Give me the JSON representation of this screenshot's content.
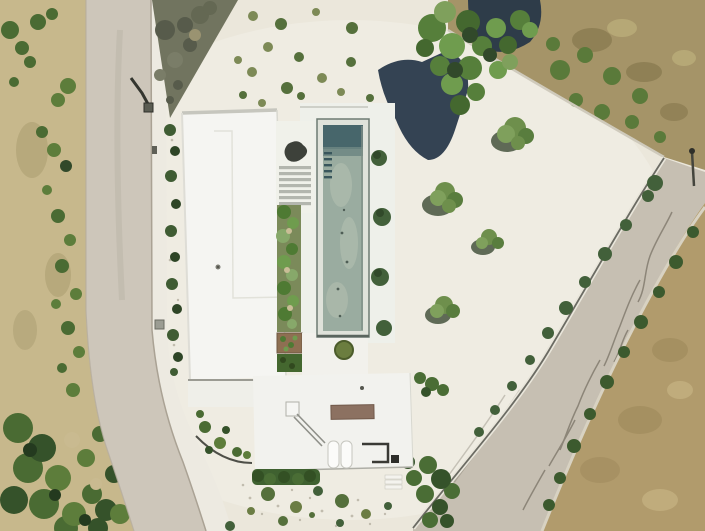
{
  "image": {
    "kind": "aerial drone photograph (top-down)",
    "subject": "modern white flat-roof villa with long lap pool on a white gravel corner lot, bordered by a curved street on the west and a diagonal street on the east",
    "no_text_visible": true
  },
  "palette": {
    "gravel": "#ebe7db",
    "gravel_light": "#f4f2ea",
    "road_left": "#cdc6ba",
    "road_right": "#c6bfb2",
    "sidewalk": "#edeae1",
    "scrub_dry": "#c7b88c",
    "neighbor_dry": "#a59468",
    "field_dry": "#b19b6c",
    "rubble": "#71745f",
    "roof": "#f5f5f2",
    "lower_roof": "#f2f2ee",
    "terrace": "#efefe9",
    "pool_rim": "#dfe2da",
    "pool_deep": "#47666b",
    "pool_water": "#9aaca0",
    "deck": "#eef0ea",
    "garden": "#7b8a5a",
    "hedge": "#3f6130",
    "planter": "#8e6f52",
    "roof_terrace_brown": "#8c7161",
    "tree_green": "#567f3b",
    "tree_shadow": "#243447",
    "olive": "#6e8f4c",
    "bush_dark": "#42603a",
    "wall_line": "#55554d",
    "tar_mark": "#6e675a"
  },
  "scene": {
    "roads": {
      "left_road": "street running north-south, curving south-east at bottom",
      "right_road": "street running diagonally from north-east corner to bottom",
      "sidewalk": "white sidewalk with curb along east side of left road",
      "markings": "dark tar-repair squiggles on right road surface"
    },
    "house": {
      "main_wing": "long white flat roof on west side of courtyard",
      "lower_wing": "white flat roof at south with brown roof-terrace rectangle",
      "stair": "external stair with diagonal railing shadow on lower wing",
      "vents": "two white cylindrical rooftop elements",
      "pool": {
        "type": "long rectangular lap pool",
        "water": "pale sage-green, dark teal deep end at north",
        "ladder_rungs": 5
      },
      "garden_bed": "planted green strip between main wing and pool",
      "louvers": "slatted pergola section north of garden bed",
      "planter": "brown planter box south of garden bed",
      "hedges": "clipped hedge rows south of planter and along south facade",
      "steps": "small outside stair south-east of lower wing"
    },
    "vegetation": {
      "big_tree": "large pine with dark cast shadow north of pool",
      "olive_trees": 4,
      "shrub_rows": "bushes along west facade, along east boundary wall, along right-road fence",
      "scrubland_west": "dry scrub with green bushes west of left road",
      "bottom_left_corner": "dense green shrub mass",
      "gravel_shrubs": "small scattered shrubs on white gravel yard"
    },
    "lots": {
      "subject_lot": "white gravel corner lot",
      "neighbor_north_east": "dry scrubby fenced field",
      "field_south_east": "dry brown field beyond right road"
    },
    "objects": {
      "street_lights": 2,
      "rubble_pile": "dark rubble wedge between left road and lot at north"
    }
  }
}
